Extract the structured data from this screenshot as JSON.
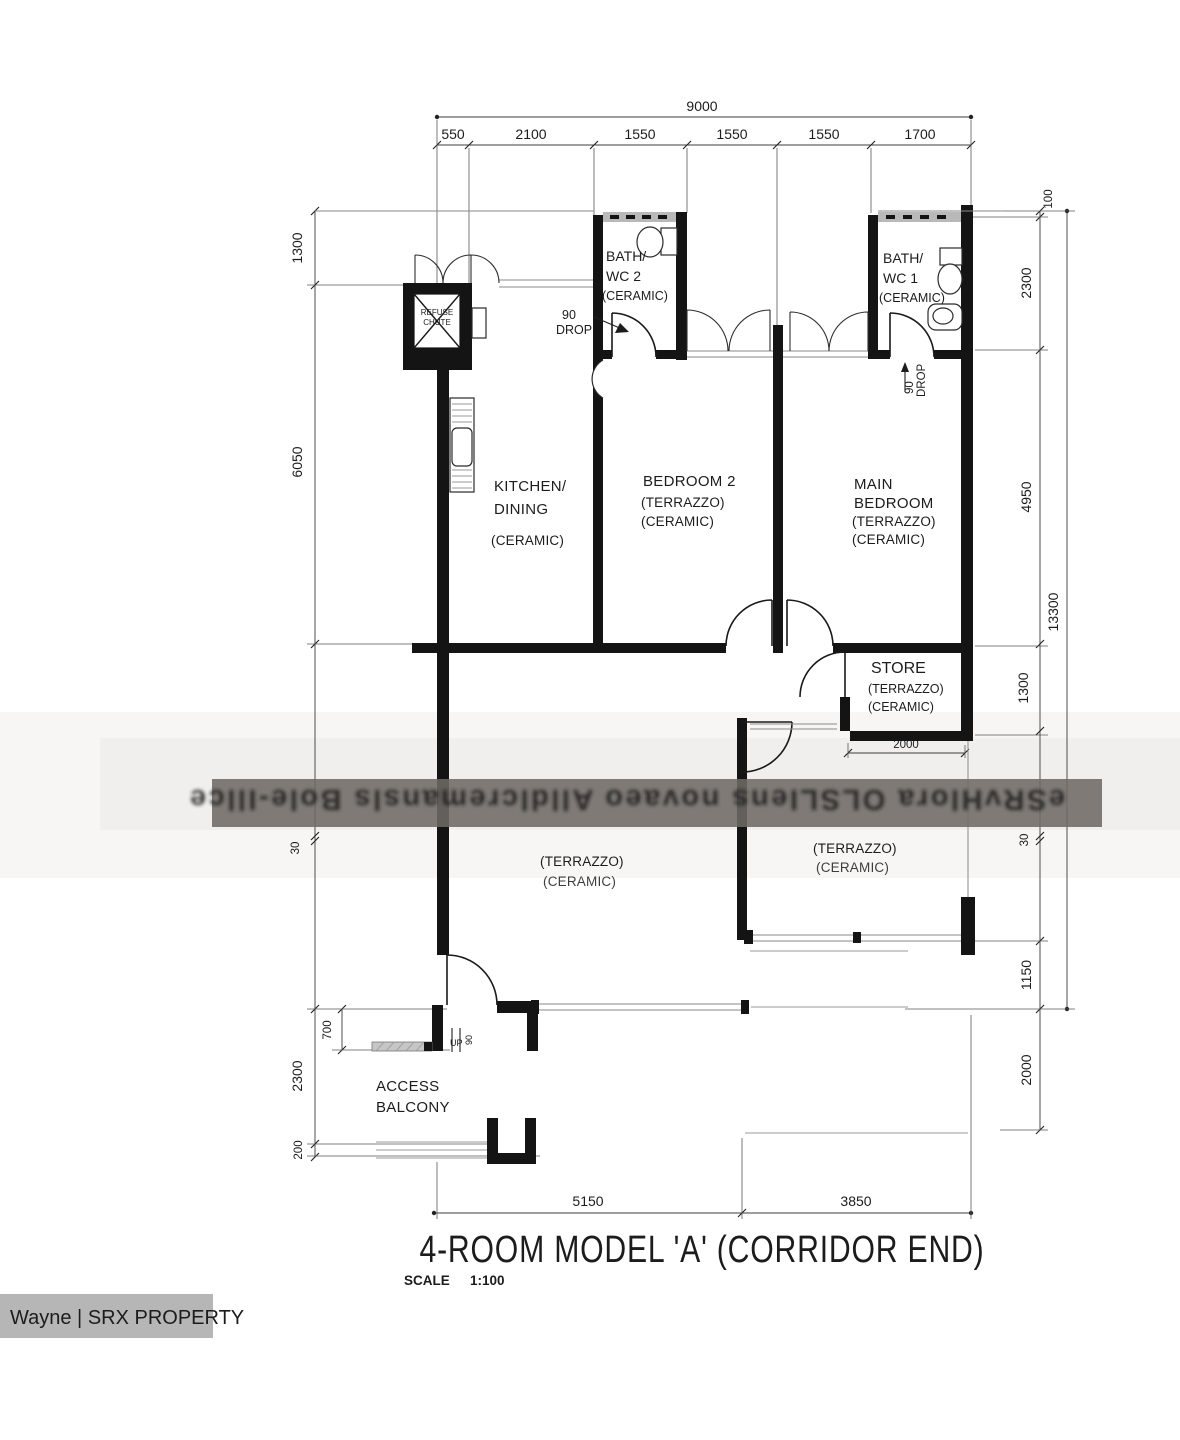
{
  "title": {
    "text": "4-ROOM MODEL 'A' (CORRIDOR END)",
    "scale_label": "SCALE",
    "scale_value": "1:100"
  },
  "watermark": {
    "band_text": "eSRvHlora OLSLIens novaeo Alldlcremansls Bole-Illce",
    "attribution": "Wayne | SRX PROPERTY"
  },
  "rooms": {
    "kitchen": {
      "name1": "KITCHEN/",
      "name2": "DINING",
      "finish1": "(CERAMIC)"
    },
    "bedroom2": {
      "name1": "BEDROOM 2",
      "finish1": "(TERRAZZO)",
      "finish2": "(CERAMIC)"
    },
    "main_bedroom": {
      "name1": "MAIN",
      "name2": "BEDROOM",
      "finish1": "(TERRAZZO)",
      "finish2": "(CERAMIC)"
    },
    "bath2": {
      "name1": "BATH/",
      "name2": "WC 2",
      "finish1": "(CERAMIC)"
    },
    "bath1": {
      "name1": "BATH/",
      "name2": "WC 1",
      "finish1": "(CERAMIC)"
    },
    "store": {
      "name1": "STORE",
      "finish1": "(TERRAZZO)",
      "finish2": "(CERAMIC)"
    },
    "living_left": {
      "finish1": "(TERRAZZO)",
      "finish2": "(CERAMIC)"
    },
    "living_right": {
      "finish1": "(TERRAZZO)",
      "finish2": "(CERAMIC)"
    },
    "balcony": {
      "name1": "ACCESS",
      "name2": "BALCONY"
    },
    "refuse_chute": {
      "name1": "REFUSE",
      "name2": "CHUTE"
    }
  },
  "annotations": {
    "drop2_num": "90",
    "drop2_word": "DROP",
    "drop1_num": "90",
    "drop1_word": "DROP",
    "up": "UP",
    "up_step": "90"
  },
  "dimensions": {
    "top_total": "9000",
    "top_segments": [
      "550",
      "2100",
      "1550",
      "1550",
      "1550",
      "1700"
    ],
    "left": [
      "1300",
      "6050",
      "30",
      "700",
      "2300",
      "200"
    ],
    "right": [
      "100",
      "2300",
      "4950",
      "13300",
      "1300",
      "30",
      "1150",
      "2000"
    ],
    "store_width": "2000",
    "bottom": [
      "5150",
      "3850"
    ]
  }
}
